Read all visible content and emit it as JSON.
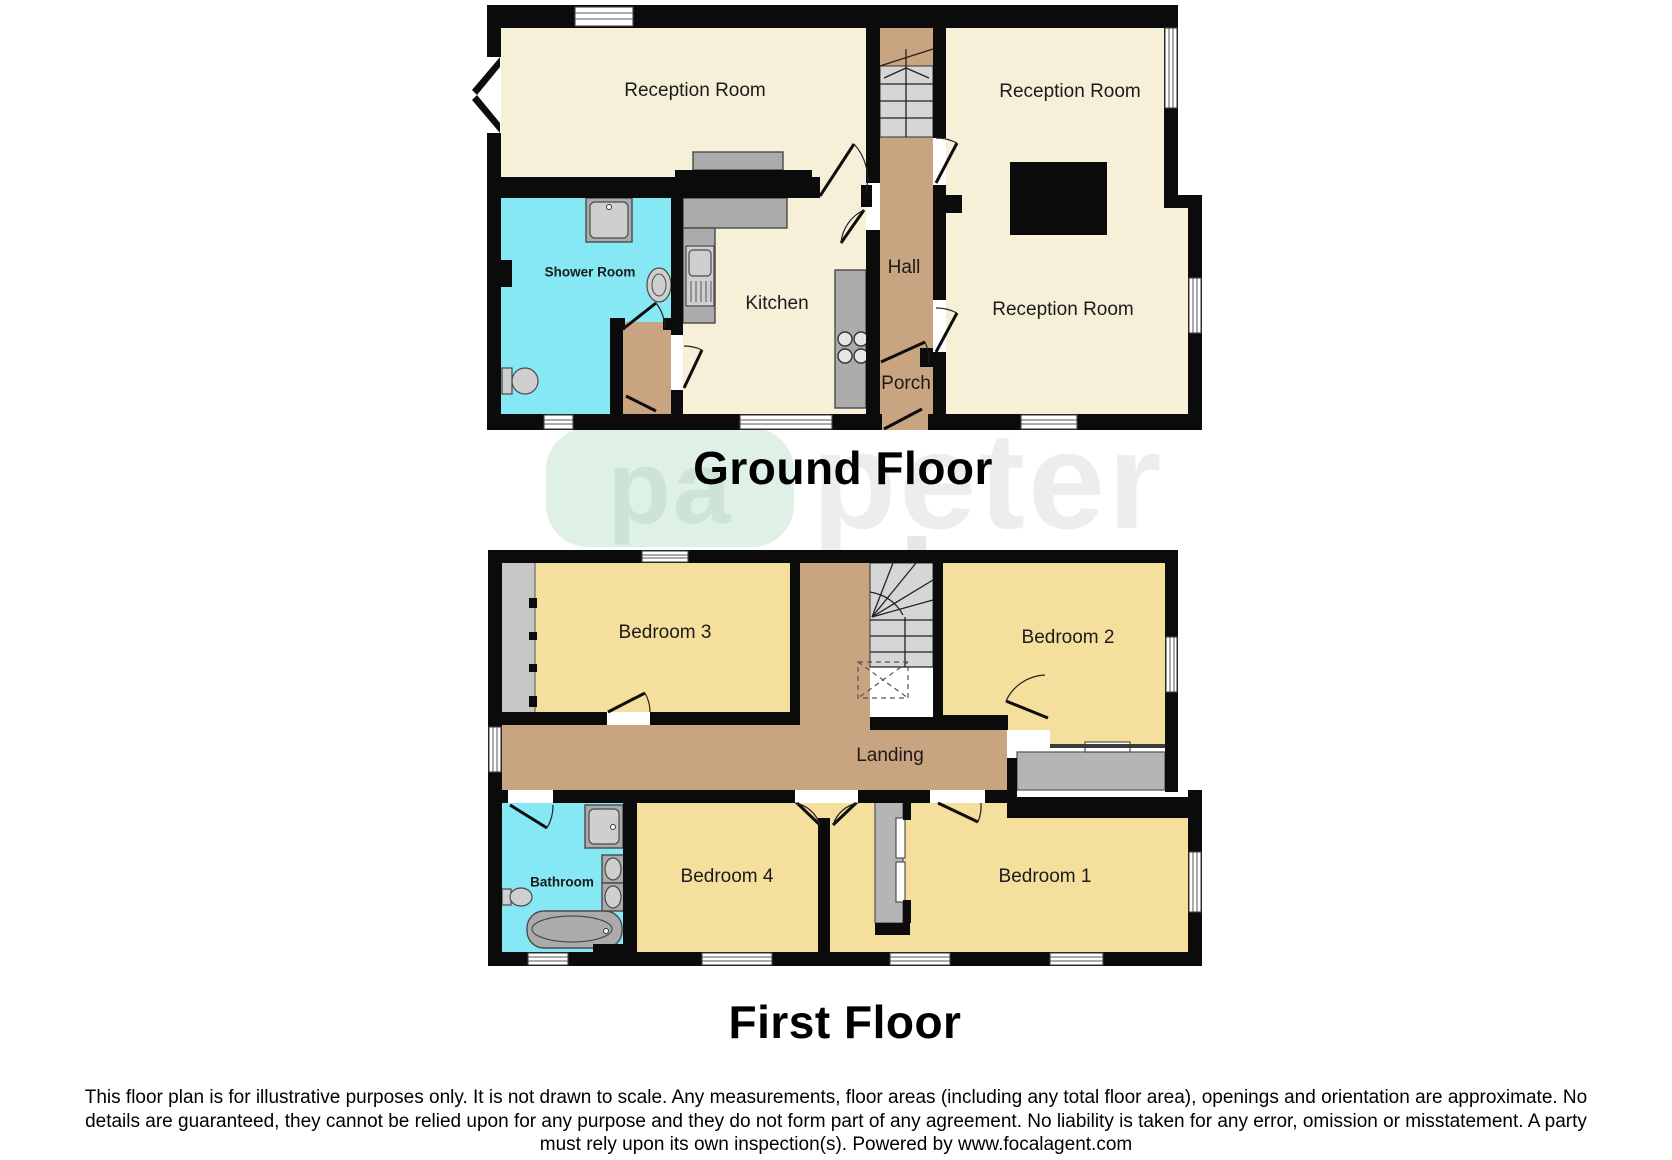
{
  "watermark": {
    "logo_text": "pa",
    "brand_line1": "peter",
    "brand_line2": "alan"
  },
  "ground_floor": {
    "title": "Ground Floor",
    "rooms": {
      "reception_top": "Reception Room",
      "reception_right_top": "Reception Room",
      "reception_right": "Reception Room",
      "shower": "Shower Room",
      "kitchen": "Kitchen",
      "hall": "Hall",
      "porch": "Porch"
    }
  },
  "first_floor": {
    "title": "First Floor",
    "rooms": {
      "bedroom3": "Bedroom 3",
      "bedroom2": "Bedroom 2",
      "landing": "Landing",
      "bathroom": "Bathroom",
      "bedroom4": "Bedroom 4",
      "bedroom1": "Bedroom 1"
    }
  },
  "disclaimer": {
    "line1": "This floor plan is for illustrative purposes only. It is not drawn to scale. Any measurements, floor areas (including any total floor area), openings and orientation are approximate. No",
    "line2": "details are guaranteed, they cannot be relied upon for any purpose and they do not form part of any agreement. No liability is taken for any error, omission or misstatement. A party",
    "line3": "must rely upon its own inspection(s). Powered by www.focalagent.com"
  },
  "colors": {
    "wall": "#0b0b0b",
    "cream": "#f6f0d9",
    "yellow": "#f5df9c",
    "tan": "#c8a481",
    "cyan": "#86e7f5",
    "fixture": "#ababab",
    "stair": "#d6d6d6",
    "mint": "#dff0e7",
    "mintText": "#cbe4d5"
  }
}
